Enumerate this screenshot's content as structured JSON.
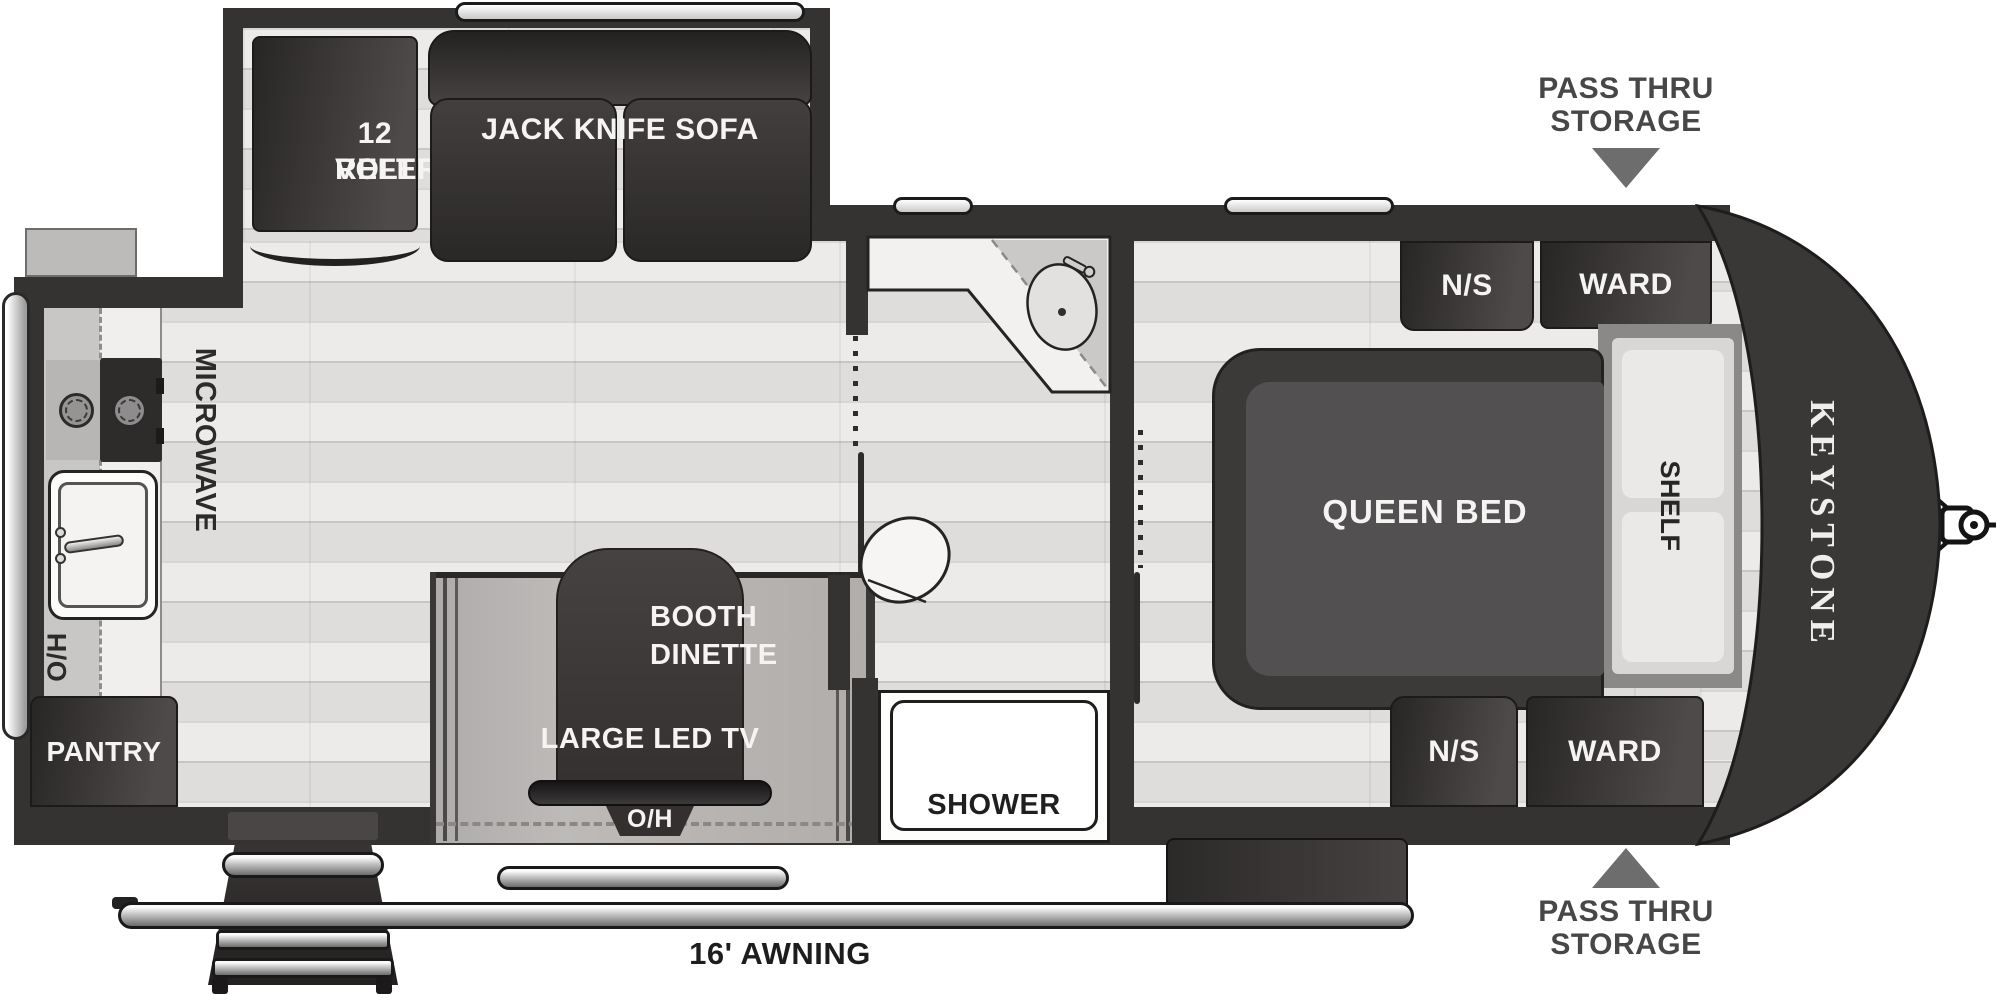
{
  "title": "Keystone travel trailer floor plan",
  "colors": {
    "wall": "#353232",
    "floor": "#e9e8e6",
    "slide_floor": "#b6b3b1",
    "cabinet_dark": "#353131",
    "fixture_white": "#fdfdfc",
    "label_light": "#f5f4f3",
    "label_dark": "#2b2b2b",
    "storage_arrow": "#6d6d6d"
  },
  "labels": {
    "refer1": "12 VOLT",
    "refer2": "REFER",
    "sofa": "JACK KNIFE SOFA",
    "microwave": "MICROWAVE",
    "kitchen_oh": "O/H",
    "pantry": "PANTRY",
    "booth1": "BOOTH",
    "booth2": "DINETTE",
    "tv": "LARGE LED TV",
    "tv_oh": "O/H",
    "shower": "SHOWER",
    "queen_bed": "QUEEN BED",
    "shelf": "SHELF",
    "ns_top": "N/S",
    "ns_bottom": "N/S",
    "ward_top": "WARD",
    "ward_bottom": "WARD",
    "brand": "KEYSTONE",
    "pass_top1": "PASS THRU",
    "pass_top2": "STORAGE",
    "pass_bottom1": "PASS THRU",
    "pass_bottom2": "STORAGE",
    "awning": "16' AWNING"
  }
}
